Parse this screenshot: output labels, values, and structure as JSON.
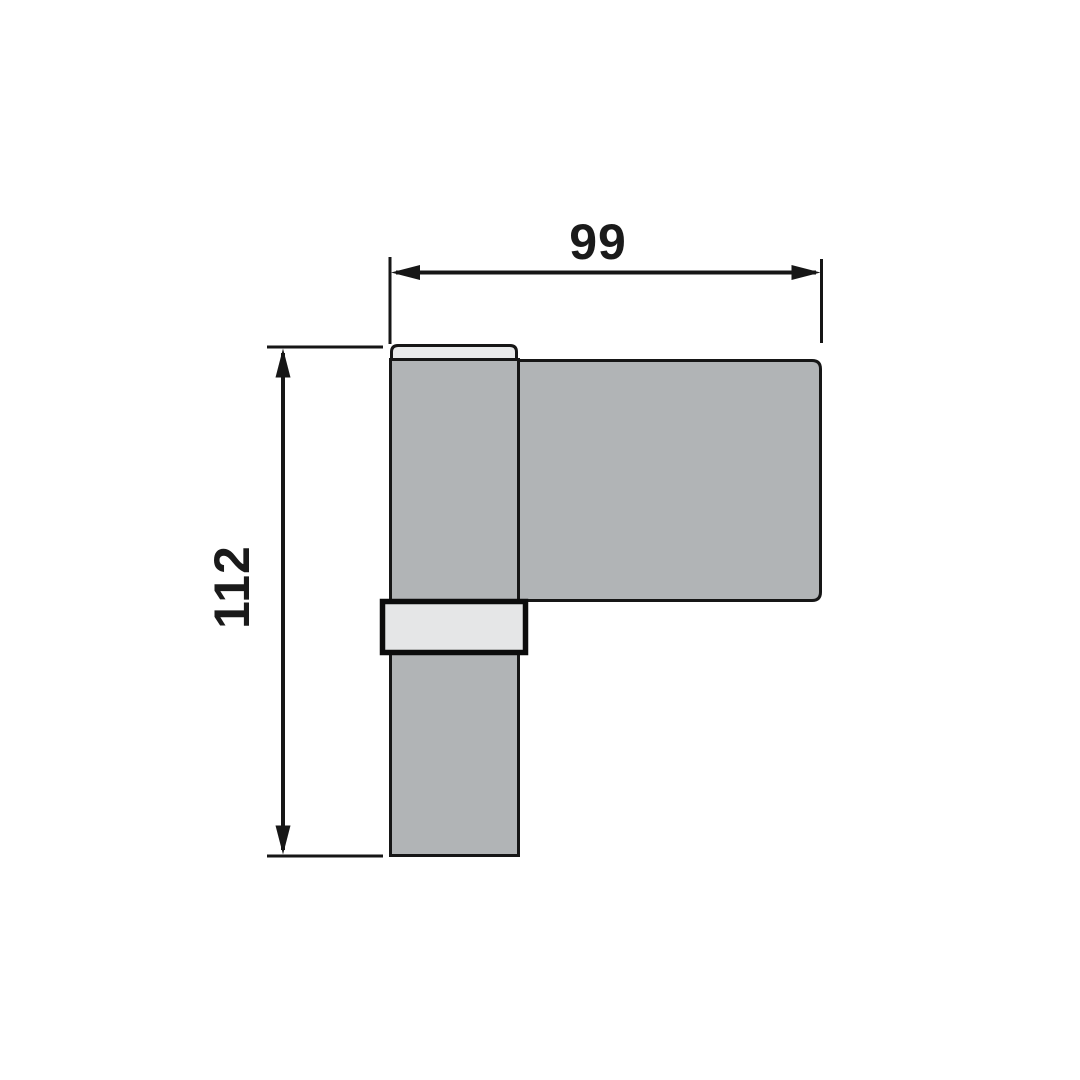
{
  "drawing": {
    "kind": "technical-dimension-drawing",
    "dimensions": {
      "width_label": "99",
      "height_label": "112"
    },
    "colors": {
      "background": "#ffffff",
      "part_fill": "#b1b4b6",
      "cap_fill": "#e9eaeb",
      "sleeve_fill": "#e5e6e7",
      "line": "#161616",
      "text": "#1a1a1a"
    },
    "parts": {
      "frame_leaf": "frame-leaf-bar",
      "door_leaf": "door-leaf-plate",
      "top_cap": "top-cap",
      "center_sleeve": "center-sleeve"
    }
  }
}
